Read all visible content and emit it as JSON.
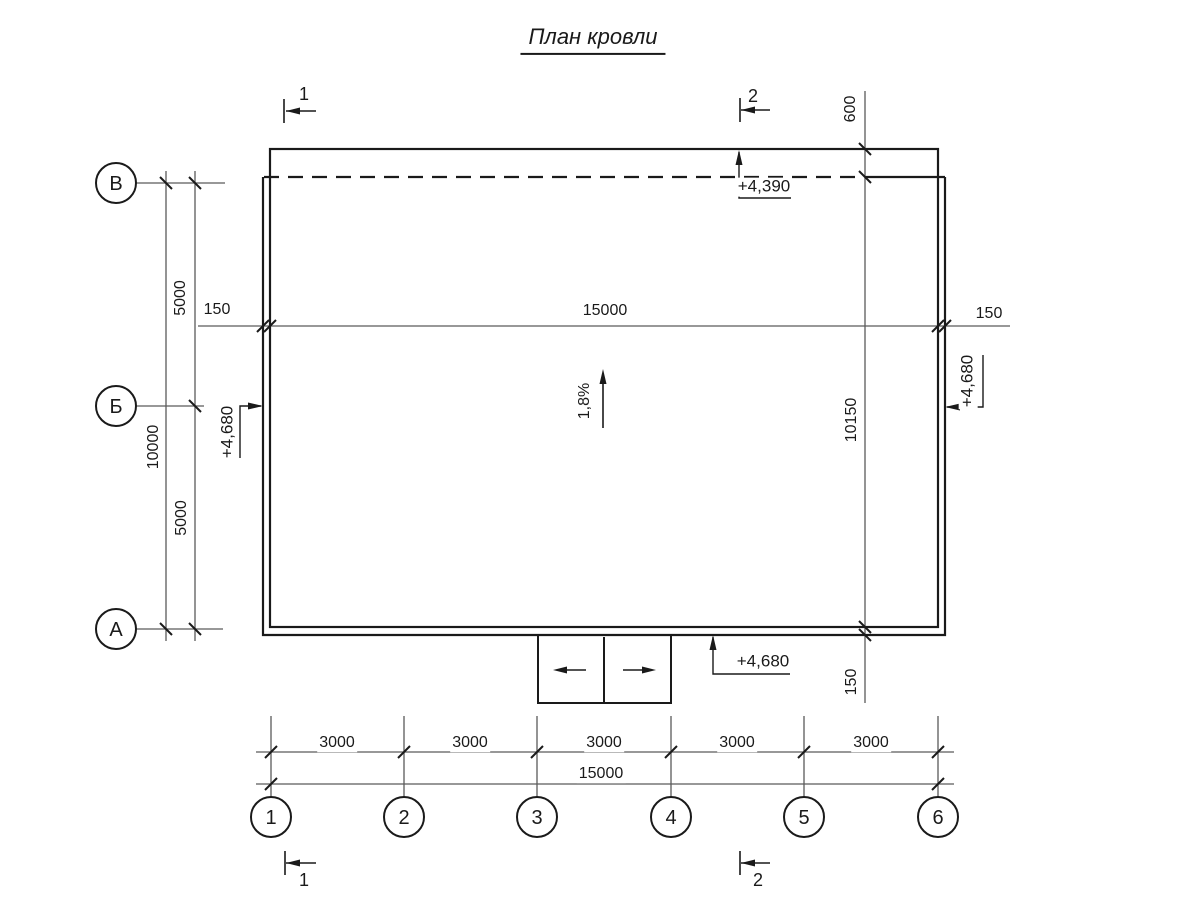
{
  "title": "План кровли",
  "axes": {
    "rows": [
      "В",
      "Б",
      "А"
    ],
    "cols": [
      "1",
      "2",
      "3",
      "4",
      "5",
      "6"
    ]
  },
  "section_cuts": {
    "cut_1": "1",
    "cut_2": "2"
  },
  "dimensions": {
    "left_upper": "5000",
    "left_total": "10000",
    "left_lower": "5000",
    "mid_left_overhang": "150",
    "mid_width": "15000",
    "mid_right_overhang": "150",
    "right_top_overhang": "600",
    "right_height": "10150",
    "right_bottom_overhang": "150",
    "bottom_bays": [
      "3000",
      "3000",
      "3000",
      "3000",
      "3000"
    ],
    "bottom_total": "15000"
  },
  "elevations": {
    "top": "+4,390",
    "left": "+4,680",
    "right": "+4,680",
    "bottom": "+4,680"
  },
  "slope": "1,8%",
  "colors": {
    "line": "#1a1a1a",
    "thin_line": "#5a5a5a",
    "background": "#ffffff"
  }
}
